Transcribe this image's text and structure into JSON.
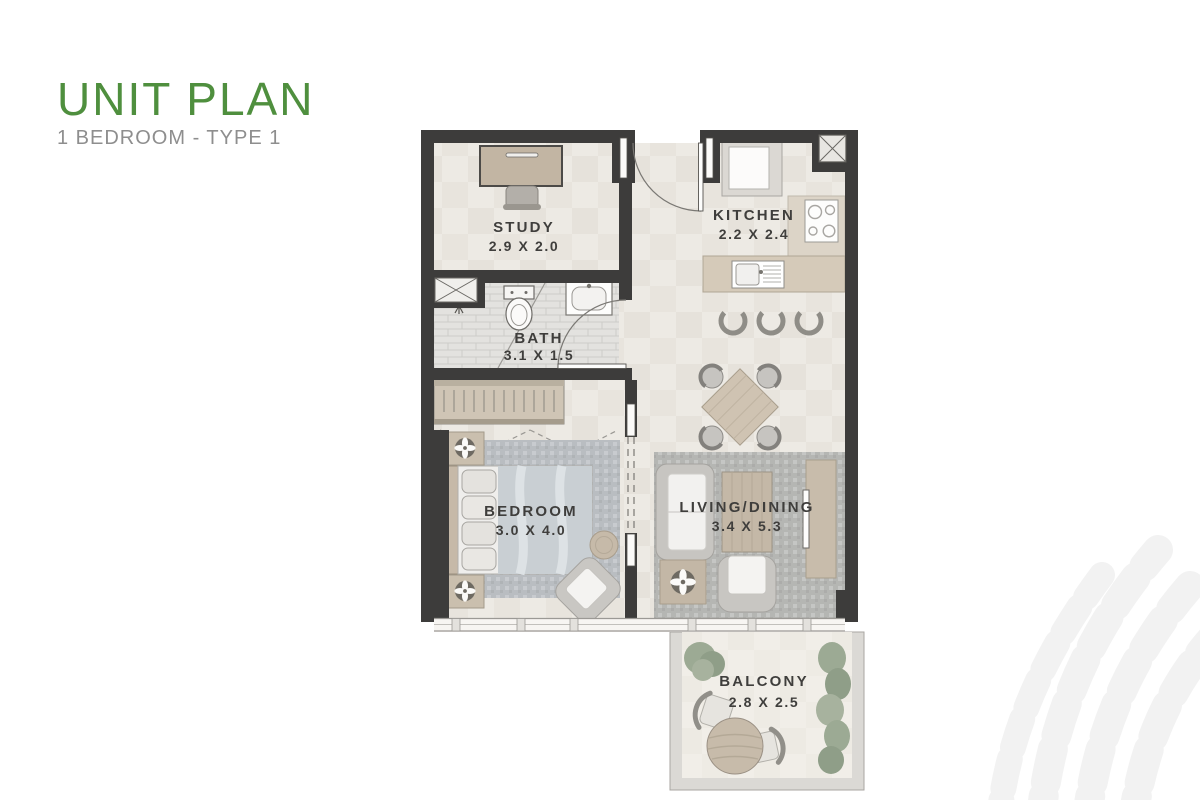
{
  "page": {
    "title": "UNIT PLAN",
    "subtitle": "1 BEDROOM - TYPE 1"
  },
  "rooms": {
    "study": {
      "name": "STUDY",
      "dims": "2.9 X 2.0"
    },
    "kitchen": {
      "name": "KITCHEN",
      "dims": "2.2 X 2.4"
    },
    "bath": {
      "name": "BATH",
      "dims": "3.1 X 1.5"
    },
    "bedroom": {
      "name": "BEDROOM",
      "dims": "3.0 X 4.0"
    },
    "living_dining": {
      "name": "LIVING/DINING",
      "dims": "3.4 X 5.3"
    },
    "balcony": {
      "name": "BALCONY",
      "dims": "2.8 X 2.5"
    }
  },
  "colors": {
    "title_green": "#4f8f3e",
    "subtitle_gray": "#8e8e8e",
    "wall_dark": "#3d3c3b",
    "floor_light": "#edeae4",
    "furniture_tan": "#cfc4b2",
    "rug_gray": "#b5b6b3",
    "plant_green": "#9caa94",
    "label_dark": "#3f3e3c",
    "watermark_gray": "#f2f2f2"
  }
}
